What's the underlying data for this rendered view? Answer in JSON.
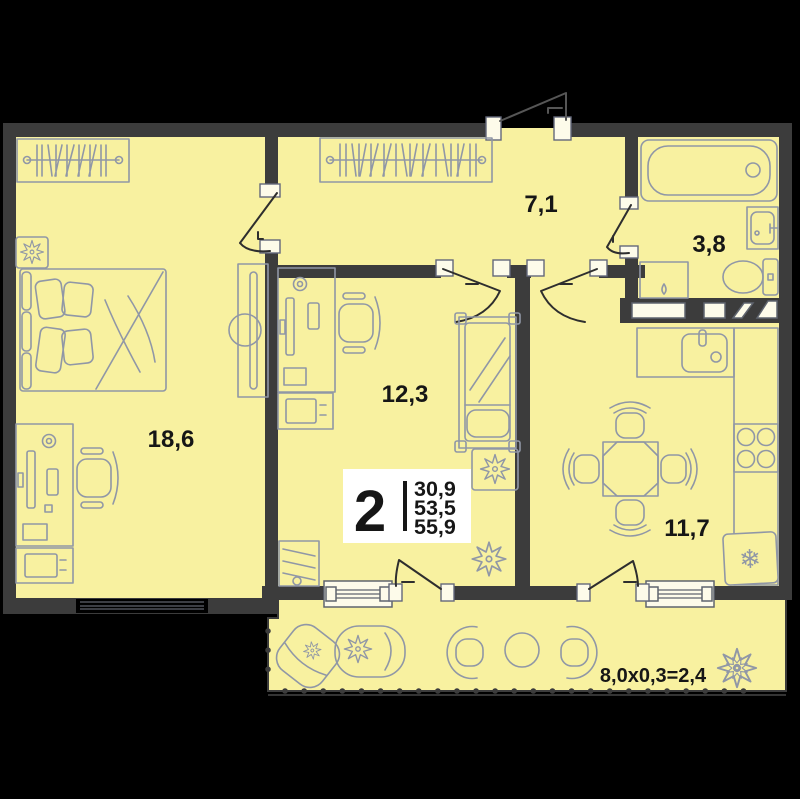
{
  "plan": {
    "badge": {
      "rooms_count": "2",
      "areas": [
        "30,9",
        "53,5",
        "55,9"
      ]
    },
    "rooms": [
      {
        "name": "bedroom",
        "area": "18,6"
      },
      {
        "name": "living-room",
        "area": "12,3"
      },
      {
        "name": "hallway",
        "area": "7,1"
      },
      {
        "name": "bathroom",
        "area": "3,8"
      },
      {
        "name": "kitchen",
        "area": "11,7"
      }
    ],
    "balcony": {
      "dimension_formula": "8,0x0,3=2,4"
    },
    "icons": {
      "snowflake": "❄"
    },
    "colors": {
      "background": "#000000",
      "wall": "#3c3c3c",
      "floor": "#f8f1a0",
      "furniture_line": "#9097a6",
      "badge_background": "#ffffff",
      "label_text": "#161616"
    }
  }
}
